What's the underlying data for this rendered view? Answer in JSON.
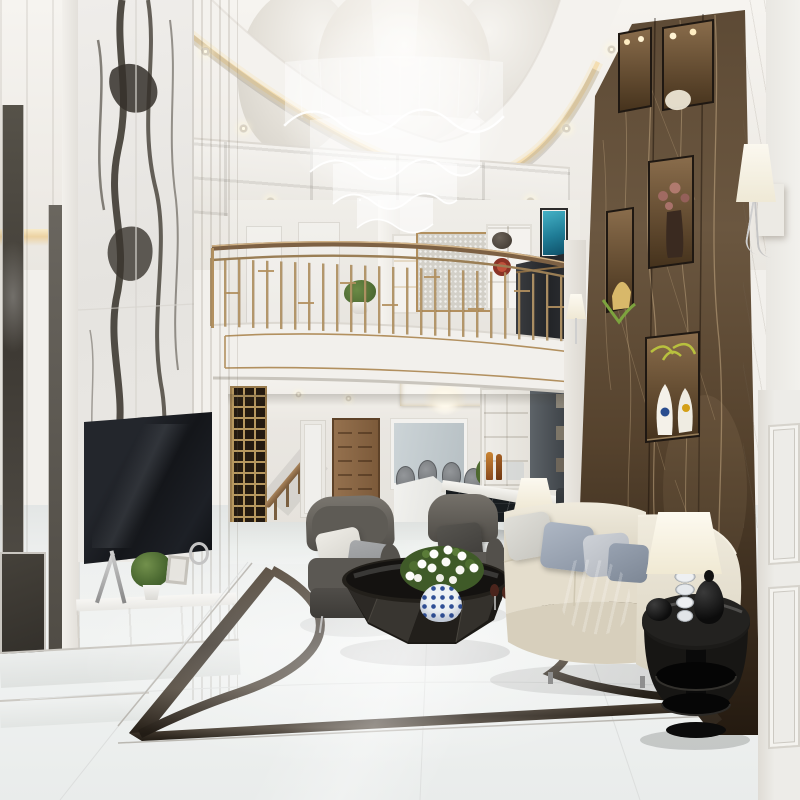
{
  "meta": {
    "kind": "photograph-recreation",
    "subject": "Luxury neoclassical double-height living room interior with mezzanine, 3D architectural render"
  },
  "palette": {
    "gold": "#b2905f",
    "goldDeep": "#8a6c44",
    "cream": "#efede8",
    "ceiling": "#f5f3ef",
    "shadowTone": "#d9d5cd",
    "brown": "#5d4a35",
    "brownDark": "#382a1c",
    "brownLight": "#7d6348",
    "vein": "#cdb289",
    "panda": "#edebe7",
    "pandaVein": "#3b362e",
    "floorA": "#f0f2f1",
    "floorB": "#dfe3e2",
    "inlay": "#3c332a",
    "sofa": "#e7e1d2",
    "pillowBlue": "#9aa3b2",
    "chairGray": "#615e59",
    "lampGlow": "#f7ecd2",
    "tableBlack": "#181614",
    "plantGreen": "#4e6e30",
    "wallWhite": "#f0efec",
    "doorWood": "#8a6848",
    "barDark": "#1d2125",
    "grayCab": "#54595e"
  },
  "scene": {
    "objects": [
      {
        "id": "crystal-chandelier",
        "label": "Tiered wave crystal chandelier"
      },
      {
        "id": "ceiling-dome",
        "label": "Sculpted ceiling dome"
      },
      {
        "id": "coffered-ceiling",
        "label": "Coffered ceiling band"
      },
      {
        "id": "cove-lighting",
        "label": "Warm cove lighting"
      },
      {
        "id": "panda-marble-wall",
        "label": "Panda white marble feature wall"
      },
      {
        "id": "television",
        "label": "Wall mounted television"
      },
      {
        "id": "tv-console",
        "label": "Marble TV console with decor"
      },
      {
        "id": "balcony-railing",
        "label": "Brass geometric balcony railing"
      },
      {
        "id": "balcony-fascia",
        "label": "Curved balcony fascia with gold trim"
      },
      {
        "id": "loft-interior",
        "label": "Mezzanine lounge interior"
      },
      {
        "id": "staircase",
        "label": "Staircase with brass lattice screen"
      },
      {
        "id": "wood-door",
        "label": "Carved wooden door"
      },
      {
        "id": "glass-doors",
        "label": "White framed glass doors"
      },
      {
        "id": "dining-set",
        "label": "Dining table with upholstered chairs"
      },
      {
        "id": "bar-counter",
        "label": "Dark marble bar counter"
      },
      {
        "id": "bar-cabinet",
        "label": "White bar display cabinet"
      },
      {
        "id": "brown-marble-wall",
        "label": "Brown Emperador marble accent wall"
      },
      {
        "id": "display-niches",
        "label": "Lit display niches"
      },
      {
        "id": "wall-sconce",
        "label": "White cone wall sconce"
      },
      {
        "id": "armchair-left",
        "label": "Gray leather armchair"
      },
      {
        "id": "armchair-right",
        "label": "Gray leather armchair"
      },
      {
        "id": "coffee-table",
        "label": "Faceted black coffee table"
      },
      {
        "id": "daisy-centerpiece",
        "label": "White daisy centerpiece"
      },
      {
        "id": "sofa",
        "label": "Cream upholstered sofa"
      },
      {
        "id": "side-table",
        "label": "Black oval side table"
      },
      {
        "id": "table-lamp",
        "label": "Glass base table lamp"
      },
      {
        "id": "marble-floor",
        "label": "Polished white marble floor"
      },
      {
        "id": "floor-inlay",
        "label": "Dark marble floor inlay border"
      },
      {
        "id": "panel-door",
        "label": "White panel door"
      },
      {
        "id": "floor-lamp",
        "label": "Floor lamp beside sofa"
      },
      {
        "id": "gray-cabinet",
        "label": "Tall gray cabinet"
      },
      {
        "id": "dining-chandelier",
        "label": "Small dining chandelier"
      },
      {
        "id": "flower-bouquet",
        "label": "Yellow flower bouquet"
      },
      {
        "id": "decor-objects",
        "label": "Black decorative vessels"
      },
      {
        "id": "wall-art",
        "label": "Teal wall artwork"
      },
      {
        "id": "bonsai-plant",
        "label": "Mezzanine bonsai plant"
      },
      {
        "id": "niche-vases",
        "label": "Sculptural white vases"
      }
    ]
  }
}
